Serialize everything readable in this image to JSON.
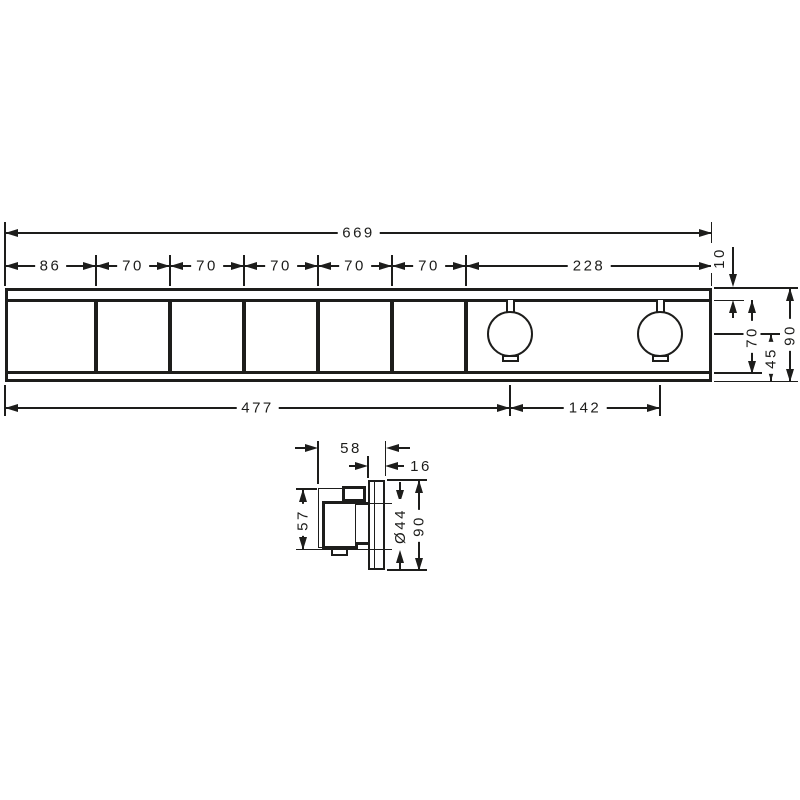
{
  "front": {
    "overall_width": "669",
    "segments": [
      "86",
      "70",
      "70",
      "70",
      "70",
      "70",
      "228"
    ],
    "top_offset": "10",
    "inner_height": "70",
    "center_from_bottom": "45",
    "overall_height": "90",
    "left_to_handle": "477",
    "handle_spacing": "142"
  },
  "side": {
    "depth": "58",
    "plate_depth": "16",
    "handle_height": "57",
    "handle_diameter": "Ø44",
    "height": "90"
  }
}
